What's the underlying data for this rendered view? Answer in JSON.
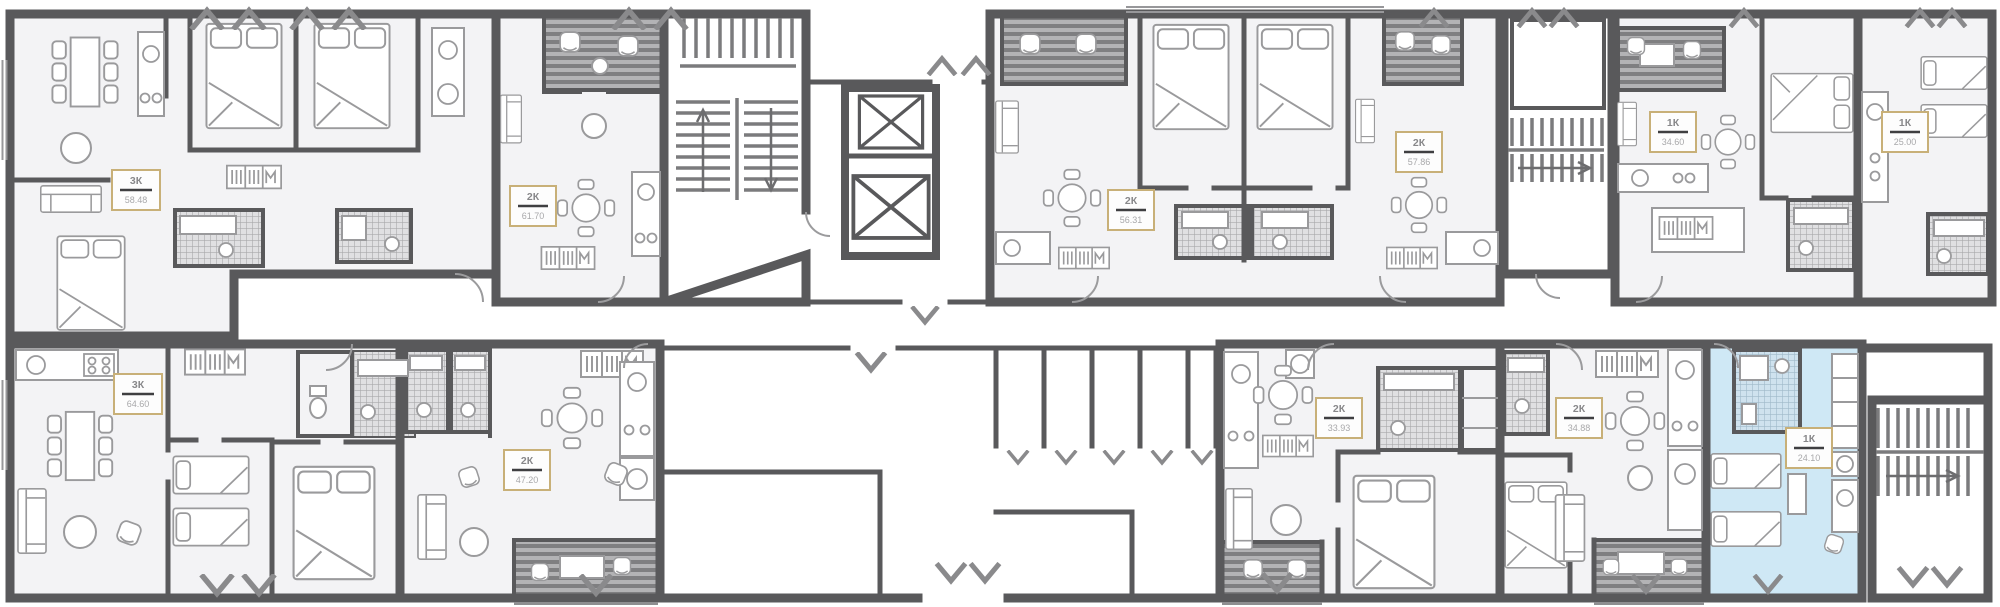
{
  "plan": {
    "name": "floor-plan",
    "wall_color": "#59595b",
    "room_fill": "#f3f3f5",
    "highlight_fill": "#cfe8f5",
    "label_border": "#c8b078",
    "apartments": [
      {
        "id": "top-1",
        "type": "3К",
        "area": "58.48",
        "highlighted": false
      },
      {
        "id": "top-2",
        "type": "2К",
        "area": "61.70",
        "highlighted": false
      },
      {
        "id": "top-3",
        "type": "2К",
        "area": "56.31",
        "highlighted": false
      },
      {
        "id": "top-4",
        "type": "2К",
        "area": "57.86",
        "highlighted": false
      },
      {
        "id": "top-5",
        "type": "1К",
        "area": "34.60",
        "highlighted": false
      },
      {
        "id": "top-6",
        "type": "1К",
        "area": "25.00",
        "highlighted": false
      },
      {
        "id": "bottom-1",
        "type": "3К",
        "area": "64.60",
        "highlighted": false
      },
      {
        "id": "bottom-2",
        "type": "2К",
        "area": "47.20",
        "highlighted": false
      },
      {
        "id": "bottom-3",
        "type": "2К",
        "area": "33.93",
        "highlighted": false
      },
      {
        "id": "bottom-4",
        "type": "2К",
        "area": "34.88",
        "highlighted": false
      },
      {
        "id": "bottom-5",
        "type": "1К",
        "area": "24.10",
        "highlighted": true
      }
    ]
  }
}
